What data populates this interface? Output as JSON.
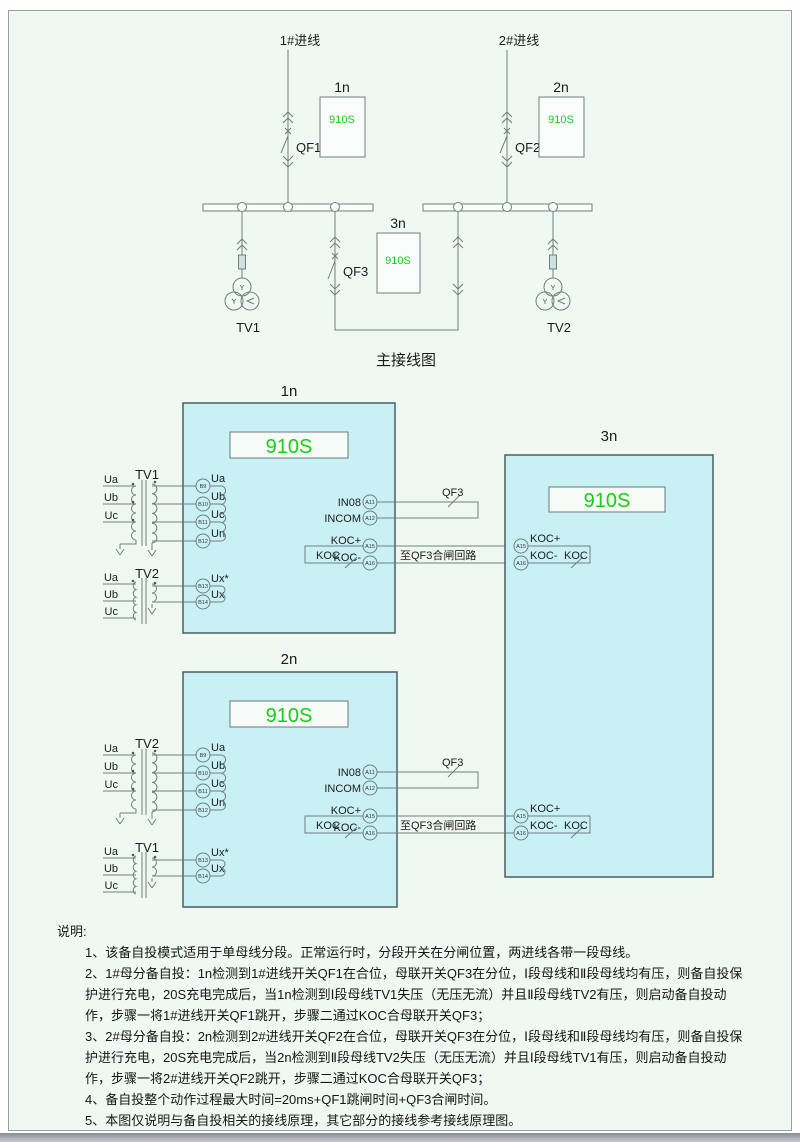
{
  "colors": {
    "accent_green": "#17cd17",
    "device_box_fill": "#c9f0f4",
    "page_bg": "#eff9f1",
    "line": "#6f7f7f"
  },
  "main": {
    "caption": "主接线图",
    "in1": "1#进线",
    "in2": "2#进线",
    "qf1": "QF1",
    "qf2": "QF2",
    "qf3": "QF3",
    "tv1": "TV1",
    "tv2": "TV2",
    "n1": "1n",
    "n2": "2n",
    "n3": "3n",
    "model": "910S",
    "wye": "Y"
  },
  "d1": {
    "title": "1n",
    "model": "910S",
    "tvtop": "TV1",
    "tvbot": "TV2",
    "pha": "Ua",
    "phb": "Ub",
    "phc": "Uc",
    "t1": "B9",
    "t1l": "Ua",
    "t2": "B10",
    "t2l": "Ub",
    "t3": "B11",
    "t3l": "Uc",
    "t4": "B12",
    "t4l": "Un",
    "t5": "B13",
    "t5l": "Ux*",
    "t6": "B14",
    "t6l": "Ux",
    "in08": "IN08",
    "a11": "A11",
    "incom": "INCOM",
    "a12": "A12",
    "kocp": "KOC+",
    "a15": "A15",
    "kocm": "KOC-",
    "a16": "A16",
    "koc": "KOC",
    "qf3": "QF3",
    "to": "至QF3合闸回路"
  },
  "d2": {
    "title": "2n",
    "model": "910S",
    "tvtop": "TV2",
    "tvbot": "TV1",
    "pha": "Ua",
    "phb": "Ub",
    "phc": "Uc",
    "t1": "B9",
    "t1l": "Ua",
    "t2": "B10",
    "t2l": "Ub",
    "t3": "B11",
    "t3l": "Uc",
    "t4": "B12",
    "t4l": "Un",
    "t5": "B13",
    "t5l": "Ux*",
    "t6": "B14",
    "t6l": "Ux",
    "in08": "IN08",
    "a11": "A11",
    "incom": "INCOM",
    "a12": "A12",
    "kocp": "KOC+",
    "a15": "A15",
    "kocm": "KOC-",
    "a16": "A16",
    "koc": "KOC",
    "qf3": "QF3",
    "to": "至QF3合闸回路"
  },
  "d3": {
    "title": "3n",
    "model": "910S",
    "g1": {
      "a15": "A15",
      "kocp": "KOC+",
      "a16": "A16",
      "kocm": "KOC-",
      "koc": "KOC"
    },
    "g2": {
      "a15": "A15",
      "kocp": "KOC+",
      "a16": "A16",
      "kocm": "KOC-",
      "koc": "KOC"
    }
  },
  "notes": {
    "heading": "说明:",
    "items": [
      "1、该备自投模式适用于单母线分段。正常运行时，分段开关在分闸位置，两进线各带一段母线。",
      "2、1#母分备自投：1n检测到1#进线开关QF1在合位，母联开关QF3在分位，Ⅰ段母线和Ⅱ段母线均有压，则备自投保护进行充电，20S充电完成后，当1n检测到Ⅰ段母线TV1失压（无压无流）并且Ⅱ段母线TV2有压，则启动备自投动作，步骤一将1#进线开关QF1跳开，步骤二通过KOC合母联开关QF3；",
      "3、2#母分备自投：2n检测到2#进线开关QF2在合位，母联开关QF3在分位，Ⅰ段母线和Ⅱ段母线均有压，则备自投保护进行充电，20S充电完成后，当2n检测到Ⅱ段母线TV2失压（无压无流）并且Ⅰ段母线TV1有压，则启动备自投动作，步骤一将2#进线开关QF2跳开，步骤二通过KOC合母联开关QF3；",
      "4、备自投整个动作过程最大时间=20ms+QF1跳闸时间+QF3合闸时间。",
      "5、本图仅说明与备自投相关的接线原理，其它部分的接线参考接线原理图。"
    ]
  }
}
